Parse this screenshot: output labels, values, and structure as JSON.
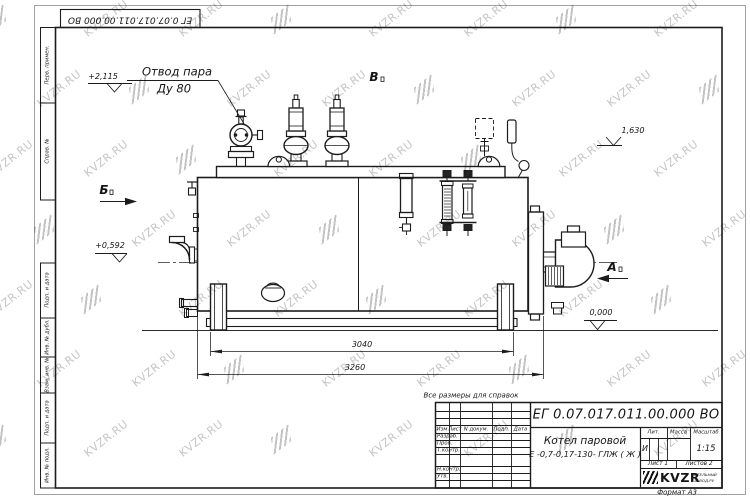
{
  "watermark": {
    "text": "KVZR.RU"
  },
  "frame": {
    "doc_number_top": "ЕГ 0.07.017.011.00.000  ВО",
    "format_note": "Формат А3",
    "margin_labels": [
      "Перв. примен.",
      "Справ. №",
      "Подп. и дата",
      "Инв. № дубл.",
      "Взам. инв. №",
      "Подп. и дата",
      "Инв. № подл."
    ]
  },
  "drawing": {
    "note": "Все размеры для справок",
    "callout": {
      "line1": "Отвод пара",
      "line2": "Ду 80"
    },
    "levels": {
      "steam_outlet": "+2,115",
      "sensor": "1,630",
      "feed": "+0,592",
      "ground": "0,000"
    },
    "dimensions": {
      "support_span": "3040",
      "overall_length": "3260"
    },
    "views": {
      "left": "Б",
      "top": "В",
      "right": "А"
    }
  },
  "title_block": {
    "doc_number": "ЕГ 0.07.017.011.00.000  ВО",
    "product_name": "Котел паровой",
    "product_code": "Е -0,7-0,17-130- ГЛЖ ( Ж )",
    "columns": {
      "izm": "Изм",
      "list": "Лист",
      "n_dokum": "N докум.",
      "podp": "Подп.",
      "data": "Дата"
    },
    "rows": {
      "razrab": "Разраб.",
      "prov": "Пров.",
      "t_kontr": "Т.контр.",
      "n_kontr": "Н.контр.",
      "utv": "Утв."
    },
    "lit_header": "Лит.",
    "massa_header": "Масса",
    "masshtab_header": "Масштаб",
    "lit_value": "И",
    "scale_value": "1:15",
    "sheet_info": "Лист 1",
    "sheets_info": "Листов 2",
    "logo_text": "KVZR",
    "company_line1": "КОТЕЛЬНЫЙ",
    "company_line2": "ЗАВОД.РУ"
  }
}
